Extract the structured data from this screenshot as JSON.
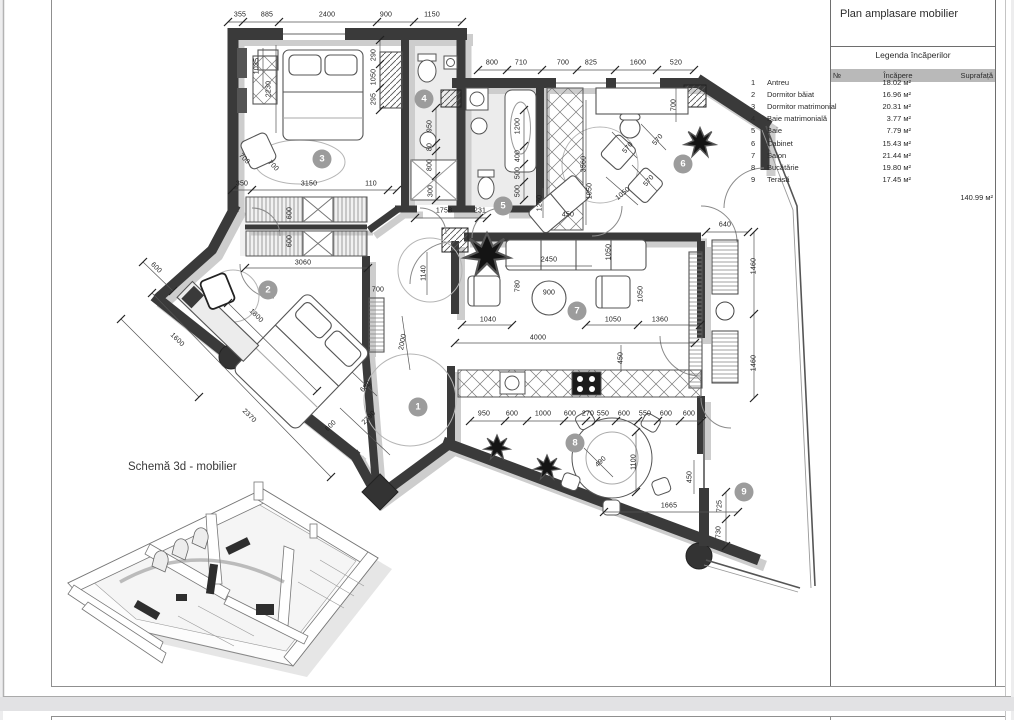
{
  "colors": {
    "wall": "#3a3a3a",
    "wall_shadow": "#cdcdcd",
    "marker": "#9c9c9c",
    "legend_header": "#b9b9b9",
    "paper": "#ffffff",
    "viewer_bg": "#ededee"
  },
  "sheet": {
    "title": "Plan amplasare mobilier",
    "schema_label": "Schemă 3d - mobilier"
  },
  "legend": {
    "subtitle": "Legenda încăperilor",
    "columns": {
      "no": "№",
      "room": "Încăpere",
      "area": "Suprafață"
    },
    "rows": [
      {
        "no": "1",
        "name": "Antreu",
        "area": "18.02 м²"
      },
      {
        "no": "2",
        "name": "Dormitor băiat",
        "area": "16.96 м²"
      },
      {
        "no": "3",
        "name": "Dormitor matrimonial",
        "area": "20.31 м²"
      },
      {
        "no": "4",
        "name": "Baie matrimonială",
        "area": "3.77 м²"
      },
      {
        "no": "5",
        "name": "Baie",
        "area": "7.79 м²"
      },
      {
        "no": "6",
        "name": "Cabinet",
        "area": "15.43 м²"
      },
      {
        "no": "7",
        "name": "Salon",
        "area": "21.44 м²"
      },
      {
        "no": "8",
        "name": "Bucătărie",
        "area": "19.80 м²"
      },
      {
        "no": "9",
        "name": "Terasă",
        "area": "17.45 м²"
      }
    ],
    "total": "140.99 м²"
  },
  "room_markers": [
    {
      "num": "1",
      "x": 418,
      "y": 407
    },
    {
      "num": "2",
      "x": 268,
      "y": 290
    },
    {
      "num": "3",
      "x": 322,
      "y": 159
    },
    {
      "num": "4",
      "x": 424,
      "y": 99
    },
    {
      "num": "5",
      "x": 503,
      "y": 206
    },
    {
      "num": "6",
      "x": 683,
      "y": 164
    },
    {
      "num": "7",
      "x": 577,
      "y": 311
    },
    {
      "num": "8",
      "x": 575,
      "y": 443
    },
    {
      "num": "9",
      "x": 744,
      "y": 492
    }
  ],
  "dimensions": [
    {
      "t": "355",
      "x": 240,
      "y": 15
    },
    {
      "t": "885",
      "x": 267,
      "y": 15
    },
    {
      "t": "2400",
      "x": 327,
      "y": 15
    },
    {
      "t": "900",
      "x": 386,
      "y": 15
    },
    {
      "t": "1150",
      "x": 432,
      "y": 15
    },
    {
      "t": "800",
      "x": 492,
      "y": 63
    },
    {
      "t": "710",
      "x": 521,
      "y": 63
    },
    {
      "t": "700",
      "x": 563,
      "y": 63
    },
    {
      "t": "825",
      "x": 591,
      "y": 63
    },
    {
      "t": "1600",
      "x": 638,
      "y": 63
    },
    {
      "t": "520",
      "x": 676,
      "y": 63
    },
    {
      "t": "1035",
      "x": 257,
      "y": 66,
      "r": -90
    },
    {
      "t": "2230",
      "x": 269,
      "y": 89,
      "r": -90
    },
    {
      "t": "290",
      "x": 374,
      "y": 55,
      "r": -90
    },
    {
      "t": "1050",
      "x": 374,
      "y": 77,
      "r": -90
    },
    {
      "t": "295",
      "x": 374,
      "y": 99,
      "r": -90
    },
    {
      "t": "700",
      "x": 244,
      "y": 159,
      "r": 45
    },
    {
      "t": "700",
      "x": 273,
      "y": 166,
      "r": 45
    },
    {
      "t": "350",
      "x": 242,
      "y": 184
    },
    {
      "t": "3150",
      "x": 309,
      "y": 184
    },
    {
      "t": "110",
      "x": 371,
      "y": 184
    },
    {
      "t": "600",
      "x": 290,
      "y": 213,
      "r": -90
    },
    {
      "t": "600",
      "x": 290,
      "y": 241,
      "r": -90
    },
    {
      "t": "3060",
      "x": 303,
      "y": 263
    },
    {
      "t": "600",
      "x": 156,
      "y": 268,
      "r": 45
    },
    {
      "t": "1800",
      "x": 256,
      "y": 316,
      "r": 45
    },
    {
      "t": "1600",
      "x": 177,
      "y": 340,
      "r": 45
    },
    {
      "t": "2370",
      "x": 249,
      "y": 416,
      "r": 45
    },
    {
      "t": "680",
      "x": 366,
      "y": 387,
      "r": -45
    },
    {
      "t": "2390",
      "x": 369,
      "y": 418,
      "r": -45
    },
    {
      "t": "600",
      "x": 331,
      "y": 426,
      "r": -45
    },
    {
      "t": "700",
      "x": 378,
      "y": 290
    },
    {
      "t": "2000",
      "x": 403,
      "y": 342,
      "r": -80
    },
    {
      "t": "1140",
      "x": 424,
      "y": 273,
      "r": -90
    },
    {
      "t": "950",
      "x": 430,
      "y": 126,
      "r": -90
    },
    {
      "t": "80",
      "x": 430,
      "y": 147,
      "r": -90
    },
    {
      "t": "800",
      "x": 430,
      "y": 165,
      "r": -90
    },
    {
      "t": "300",
      "x": 431,
      "y": 191,
      "r": -90
    },
    {
      "t": "1200",
      "x": 518,
      "y": 126,
      "r": -90
    },
    {
      "t": "400",
      "x": 518,
      "y": 156,
      "r": -90
    },
    {
      "t": "500",
      "x": 518,
      "y": 173,
      "r": -90
    },
    {
      "t": "500",
      "x": 518,
      "y": 191,
      "r": -90
    },
    {
      "t": "1758",
      "x": 444,
      "y": 211
    },
    {
      "t": "231",
      "x": 480,
      "y": 211
    },
    {
      "t": "3560",
      "x": 584,
      "y": 164,
      "r": -90
    },
    {
      "t": "1280",
      "x": 540,
      "y": 203,
      "r": -90
    },
    {
      "t": "450",
      "x": 568,
      "y": 215
    },
    {
      "t": "570",
      "x": 628,
      "y": 148,
      "r": -50
    },
    {
      "t": "570",
      "x": 658,
      "y": 140,
      "r": -50
    },
    {
      "t": "570",
      "x": 649,
      "y": 181,
      "r": -50
    },
    {
      "t": "1050",
      "x": 623,
      "y": 194,
      "r": -40
    },
    {
      "t": "1050",
      "x": 590,
      "y": 191,
      "r": -90
    },
    {
      "t": "700",
      "x": 674,
      "y": 105,
      "r": -90
    },
    {
      "t": "2450",
      "x": 549,
      "y": 260
    },
    {
      "t": "1050",
      "x": 609,
      "y": 252,
      "r": -90
    },
    {
      "t": "780",
      "x": 518,
      "y": 286,
      "r": -90
    },
    {
      "t": "900",
      "x": 549,
      "y": 293
    },
    {
      "t": "1050",
      "x": 641,
      "y": 294,
      "r": -90
    },
    {
      "t": "1040",
      "x": 488,
      "y": 320
    },
    {
      "t": "1050",
      "x": 613,
      "y": 320
    },
    {
      "t": "1360",
      "x": 660,
      "y": 320
    },
    {
      "t": "4000",
      "x": 538,
      "y": 338
    },
    {
      "t": "450",
      "x": 621,
      "y": 358,
      "r": -90
    },
    {
      "t": "640",
      "x": 725,
      "y": 225
    },
    {
      "t": "1460",
      "x": 754,
      "y": 266,
      "r": -90
    },
    {
      "t": "1460",
      "x": 754,
      "y": 363,
      "r": -90
    },
    {
      "t": "950",
      "x": 484,
      "y": 414
    },
    {
      "t": "600",
      "x": 512,
      "y": 414
    },
    {
      "t": "1000",
      "x": 543,
      "y": 414
    },
    {
      "t": "600",
      "x": 570,
      "y": 414
    },
    {
      "t": "270",
      "x": 588,
      "y": 414
    },
    {
      "t": "550",
      "x": 603,
      "y": 414
    },
    {
      "t": "600",
      "x": 624,
      "y": 414
    },
    {
      "t": "550",
      "x": 645,
      "y": 414
    },
    {
      "t": "600",
      "x": 666,
      "y": 414
    },
    {
      "t": "600",
      "x": 689,
      "y": 414
    },
    {
      "t": "490",
      "x": 601,
      "y": 462,
      "r": -45
    },
    {
      "t": "1100",
      "x": 634,
      "y": 462,
      "r": -90
    },
    {
      "t": "450",
      "x": 690,
      "y": 477,
      "r": -90
    },
    {
      "t": "1665",
      "x": 669,
      "y": 506
    },
    {
      "t": "725",
      "x": 720,
      "y": 506,
      "r": -90
    },
    {
      "t": "730",
      "x": 719,
      "y": 532,
      "r": -90
    }
  ]
}
